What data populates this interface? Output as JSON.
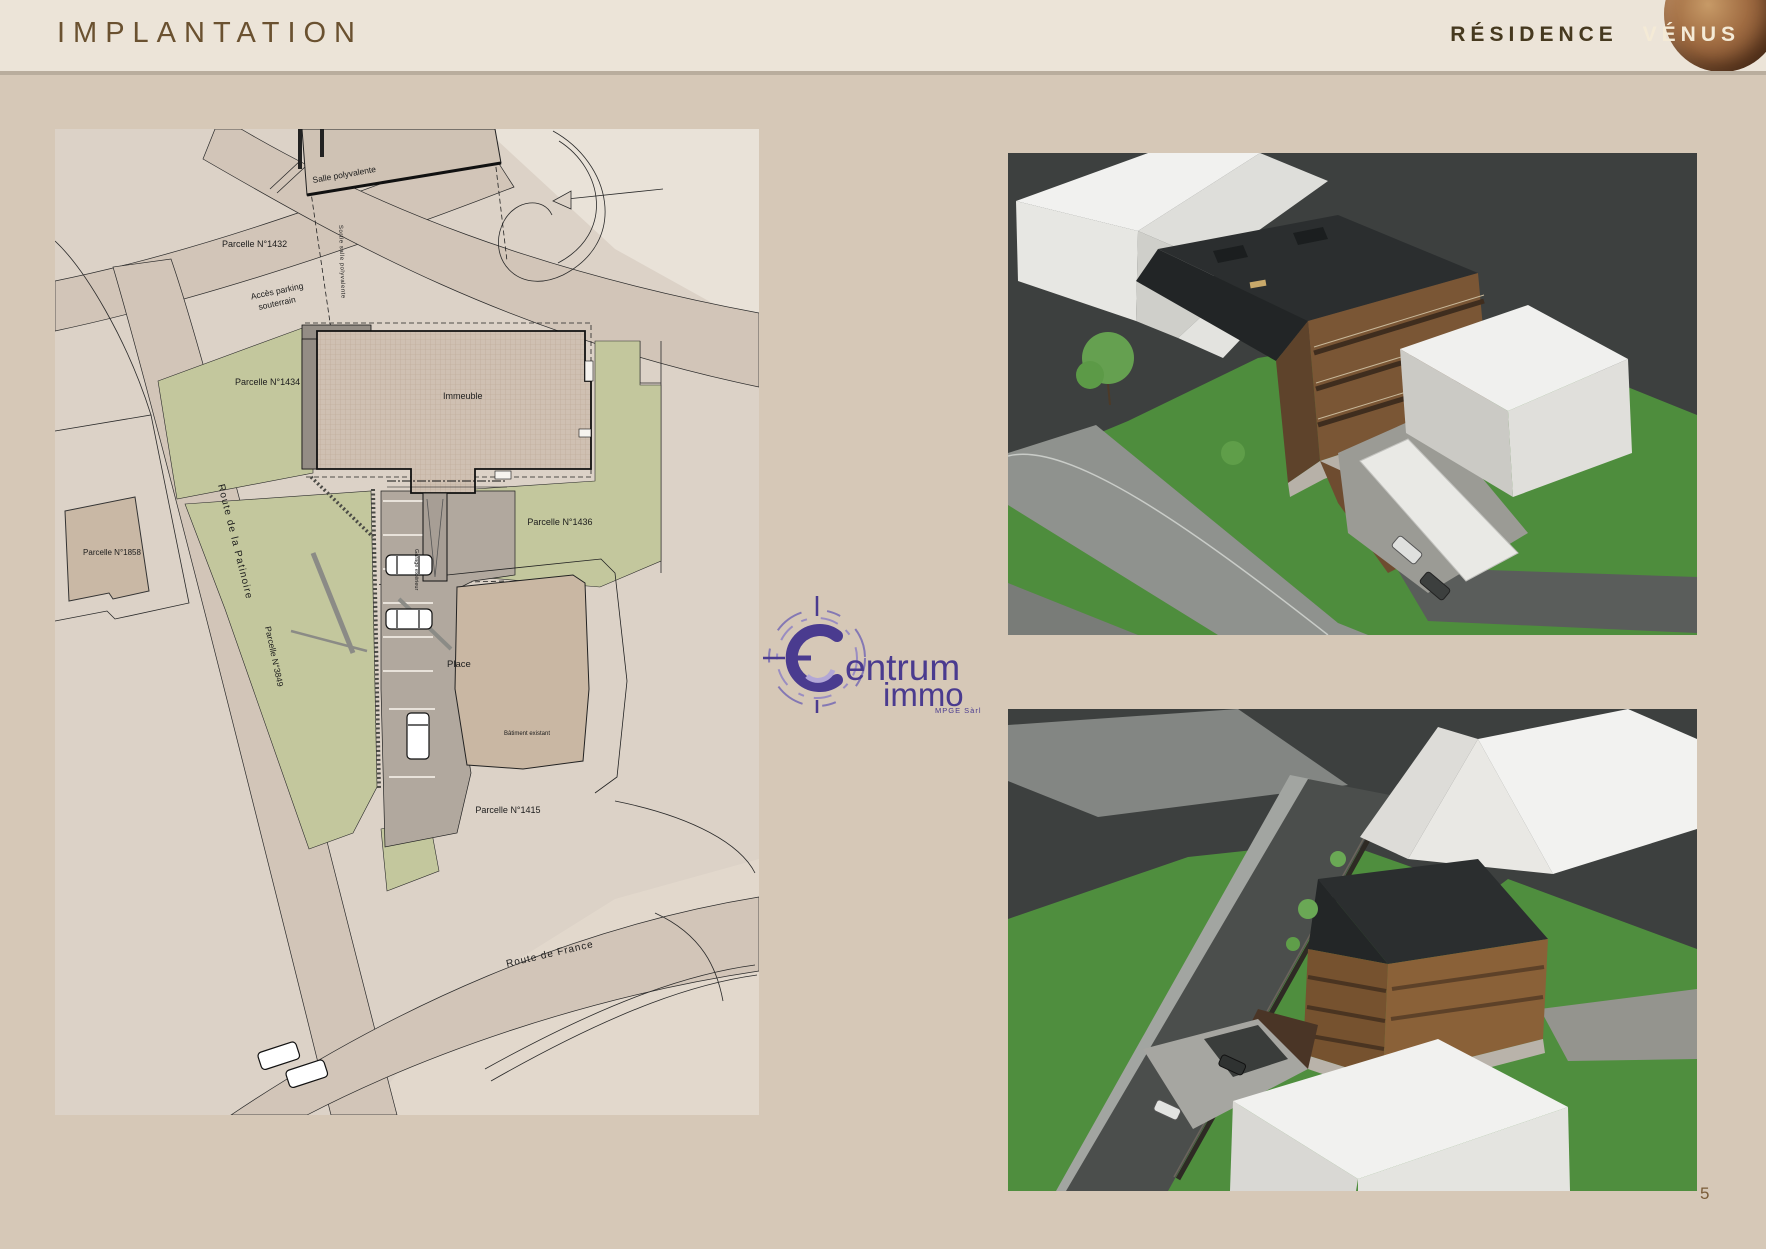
{
  "header": {
    "title": "IMPLANTATION",
    "residence": "RÉSIDENCE",
    "residence_name": "VÉNUS"
  },
  "footer": {
    "page_number": "5"
  },
  "logo": {
    "name_first_letter": "C",
    "name_rest": "entrum",
    "name_second": "immo",
    "subtitle": "MPGE Sàrl",
    "color": "#4a3b8f"
  },
  "site_plan": {
    "salle_polyvalente": "Salle polyvalente",
    "parcelle_1432": "Parcelle N°1432",
    "acces_parking_line1": "Accès parking",
    "acces_parking_line2": "souterrain",
    "sortie_salle": "Sortie salle polyvalente",
    "parcelle_1434": "Parcelle N°1434",
    "immeuble": "Immeuble",
    "parcelle_1858": "Parcelle N°1858",
    "route_patinoire": "Route de la Patinoire",
    "parcelle_1436": "Parcelle N°1436",
    "place": "Place",
    "garage_exterieur": "Garage extérieur",
    "parcelle_3849": "Parcelle N°3849",
    "batiment_existant": "Bâtiment existant",
    "parcelle_1415": "Parcelle N°1415",
    "route_france": "Route de France"
  },
  "colors": {
    "page_background": "#d6c8b7",
    "header_background": "#ece4d8",
    "title_brown": "#6a5130",
    "logo_purple": "#4a3b8f",
    "plan_green": "#c3c79d",
    "render_grass": "#4e8d3d",
    "render_sky": "#3d403f"
  }
}
